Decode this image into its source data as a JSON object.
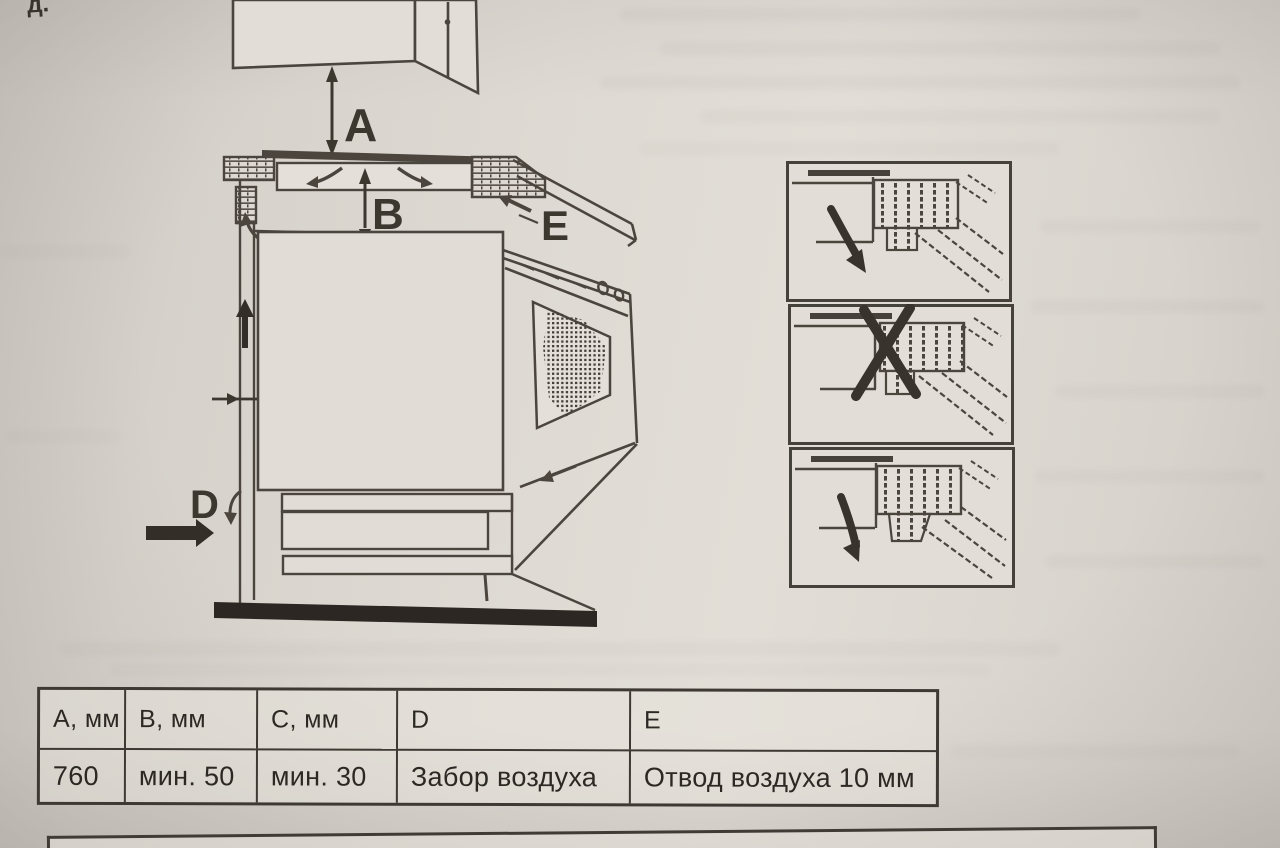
{
  "page": {
    "corner_fragment": "д."
  },
  "diagram": {
    "labels": {
      "a": "A",
      "b": "B",
      "c": "C",
      "d": "D",
      "e": "E"
    },
    "icons": {
      "dimension_arrows": "double-headed-arrow",
      "air_intake": "thick-right-arrow",
      "air_flow": "curved-arrow",
      "prohibited": "x-mark"
    }
  },
  "table": {
    "headers": [
      "А, мм",
      "В, мм",
      "С, мм",
      "D",
      "E"
    ],
    "row": [
      "760",
      "мин.  50",
      "мин. 30",
      "Забор воздуха",
      "Отвод воздуха 10 мм"
    ]
  },
  "colors": {
    "paper": "#dcd8d1",
    "ink": "#4b453e",
    "dark": "#332e28"
  }
}
